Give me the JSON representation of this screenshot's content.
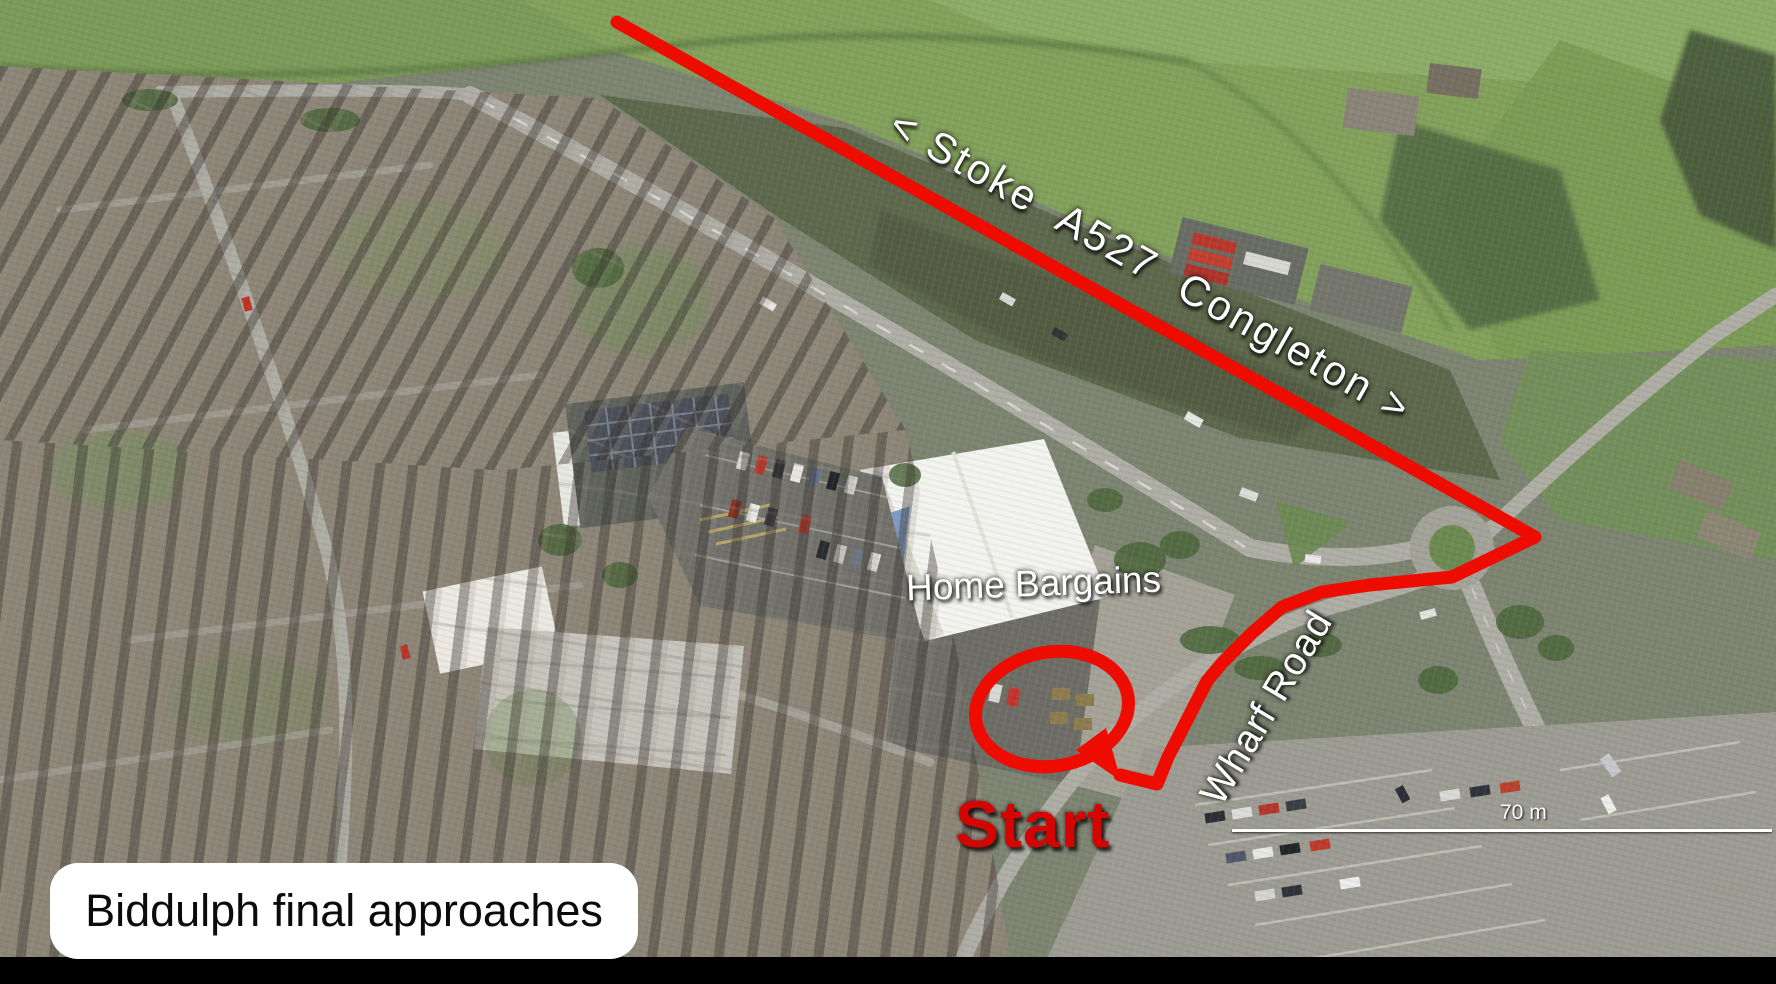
{
  "title_card": {
    "text": "Biddulph final approaches"
  },
  "labels": {
    "road_direction": "< Stoke  A527  Congleton >",
    "store": "Home Bargains",
    "road": "Wharf Road",
    "start": "Start"
  },
  "scale_bar": {
    "text": "70 m"
  },
  "colors": {
    "route_red": "#ee0b00",
    "start_red": "#d40400",
    "label_white": "#ffffff",
    "title_text": "#0b0b0b",
    "title_bg": "#ffffff",
    "letterbox": "#000000"
  },
  "route": {
    "main_points": [
      [
        617,
        22
      ],
      [
        1535,
        537
      ],
      [
        1452,
        577
      ],
      [
        1370,
        585
      ],
      [
        1322,
        592
      ],
      [
        1282,
        607
      ],
      [
        1252,
        633
      ],
      [
        1222,
        663
      ],
      [
        1207,
        681
      ],
      [
        1186,
        722
      ],
      [
        1168,
        757
      ],
      [
        1157,
        784
      ],
      [
        1120,
        775
      ]
    ],
    "start_circle": {
      "cx": 1052,
      "cy": 709,
      "rx": 77,
      "ry": 57,
      "rotation": -10
    },
    "pointer_tail": [
      [
        1076,
        750
      ],
      [
        1121,
        781
      ],
      [
        1106,
        728
      ]
    ],
    "stroke_width": 13
  }
}
